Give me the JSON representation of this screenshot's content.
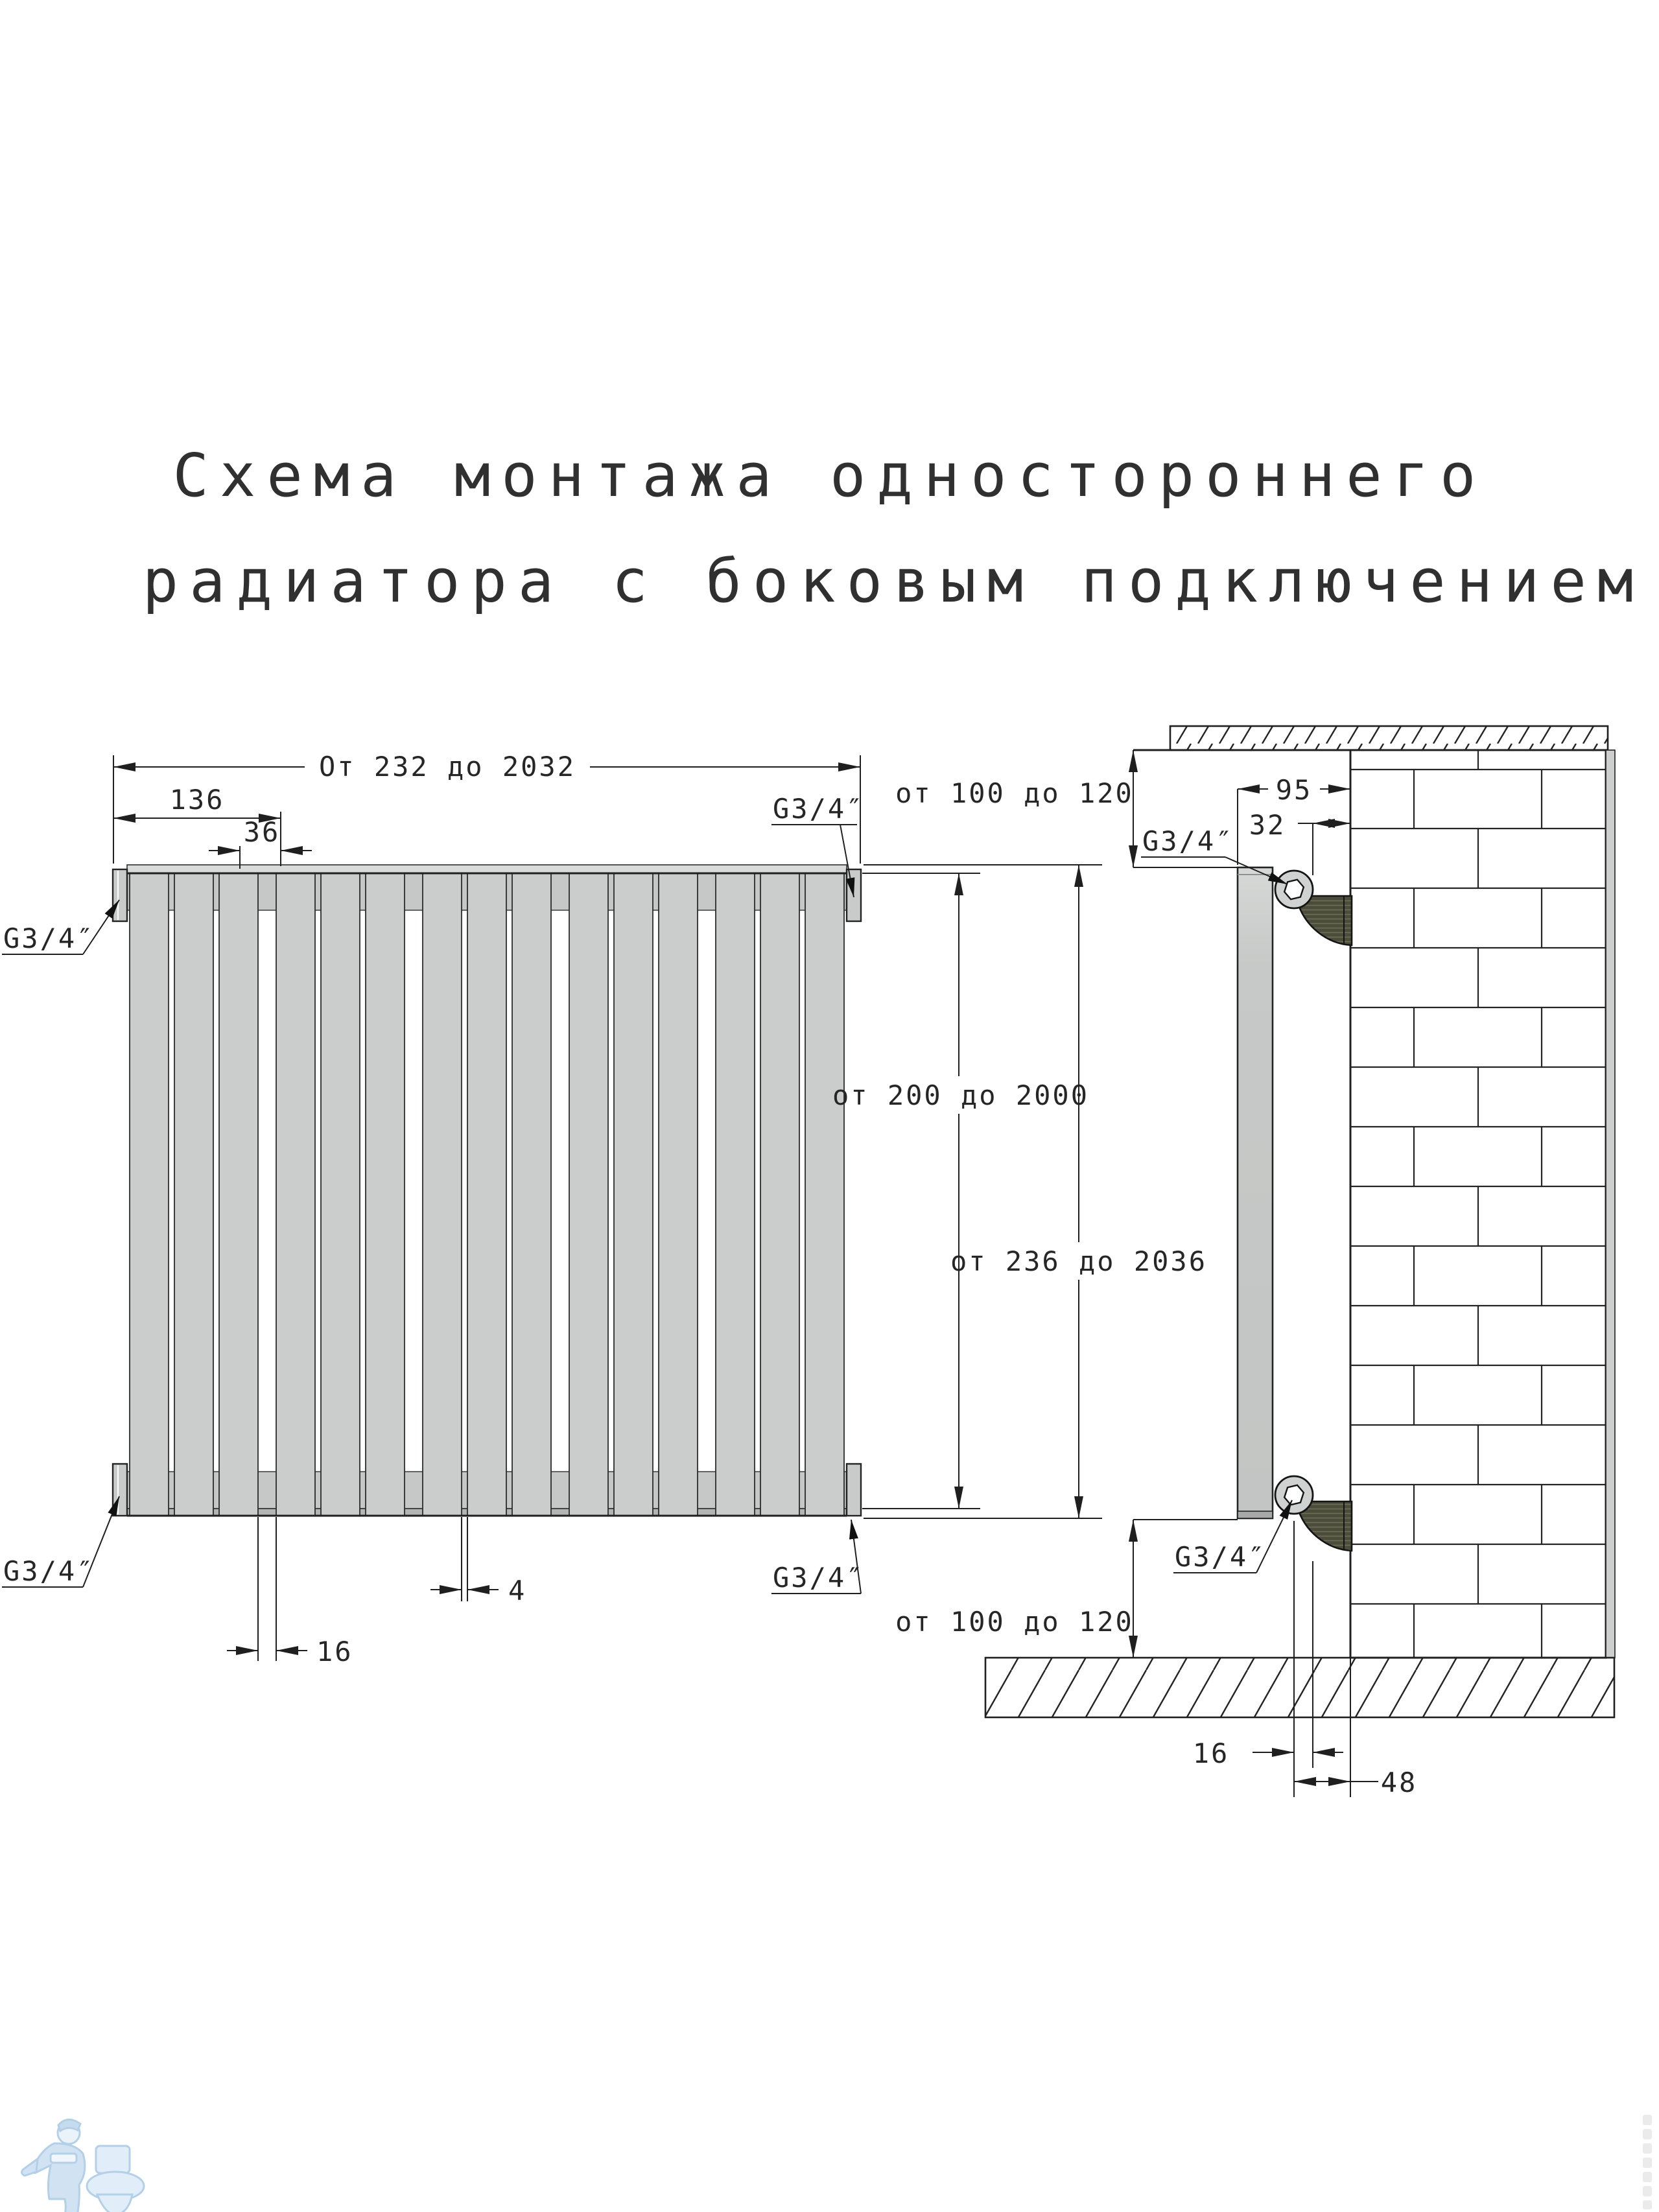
{
  "title": {
    "line1": "Схема монтажа одностороннего",
    "line2": "радиатора с боковым подключением"
  },
  "front_view": {
    "dim_overall_width": "От 232 до 2032",
    "dim_136": "136",
    "dim_36": "36",
    "dim_panel_height": "от 200 до 2000",
    "dim_overall_height": "от 236 до 2036",
    "dim_group_gap": "16",
    "dim_slot_gap": "4",
    "conn_top_left": "G3/4″",
    "conn_top_right": "G3/4″",
    "conn_bottom_left": "G3/4″",
    "conn_bottom_right": "G3/4″"
  },
  "side_view": {
    "dim_top_clearance": "от 100 до 120",
    "dim_bottom_clearance": "от 100 до 120",
    "dim_depth_95": "95",
    "dim_offset_32": "32",
    "dim_axis_16": "16",
    "dim_axis_48": "48",
    "conn_top": "G3/4″",
    "conn_bottom": "G3/4″"
  }
}
